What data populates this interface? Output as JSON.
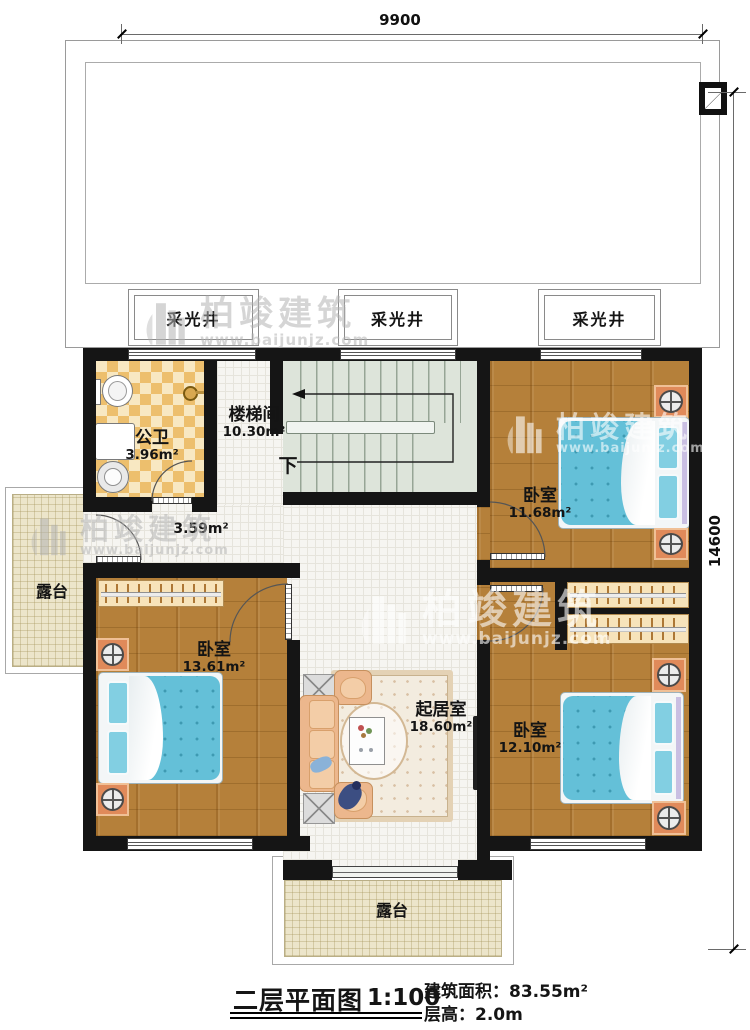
{
  "brand": {
    "name": "柏竣建筑",
    "url": "www.baijunjz.com"
  },
  "dimensions": {
    "width_top": "9900",
    "height_right": "14600"
  },
  "lightwells": {
    "lw1": "采光井",
    "lw2": "采光井",
    "lw3": "采光井"
  },
  "rooms": {
    "bathroom": {
      "name": "公卫",
      "area": "3.96m²"
    },
    "stairwell": {
      "name": "楼梯间",
      "area": "10.30m²",
      "down": "下"
    },
    "hallway": {
      "area": "3.59m²"
    },
    "bedroom_top_right": {
      "name": "卧室",
      "area": "11.68m²"
    },
    "bedroom_left": {
      "name": "卧室",
      "area": "13.61m²"
    },
    "bedroom_bottom_right": {
      "name": "卧室",
      "area": "12.10m²"
    },
    "living": {
      "name": "起居室",
      "area": "18.60m²"
    },
    "terrace_left": {
      "name": "露台"
    },
    "terrace_bottom": {
      "name": "露台"
    }
  },
  "titleblock": {
    "title": "二层平面图",
    "scale": "1:100",
    "area_label": "建筑面积：",
    "area_value": "83.55m²",
    "floor_height_label": "层高：",
    "floor_height_value": "2.0m"
  }
}
